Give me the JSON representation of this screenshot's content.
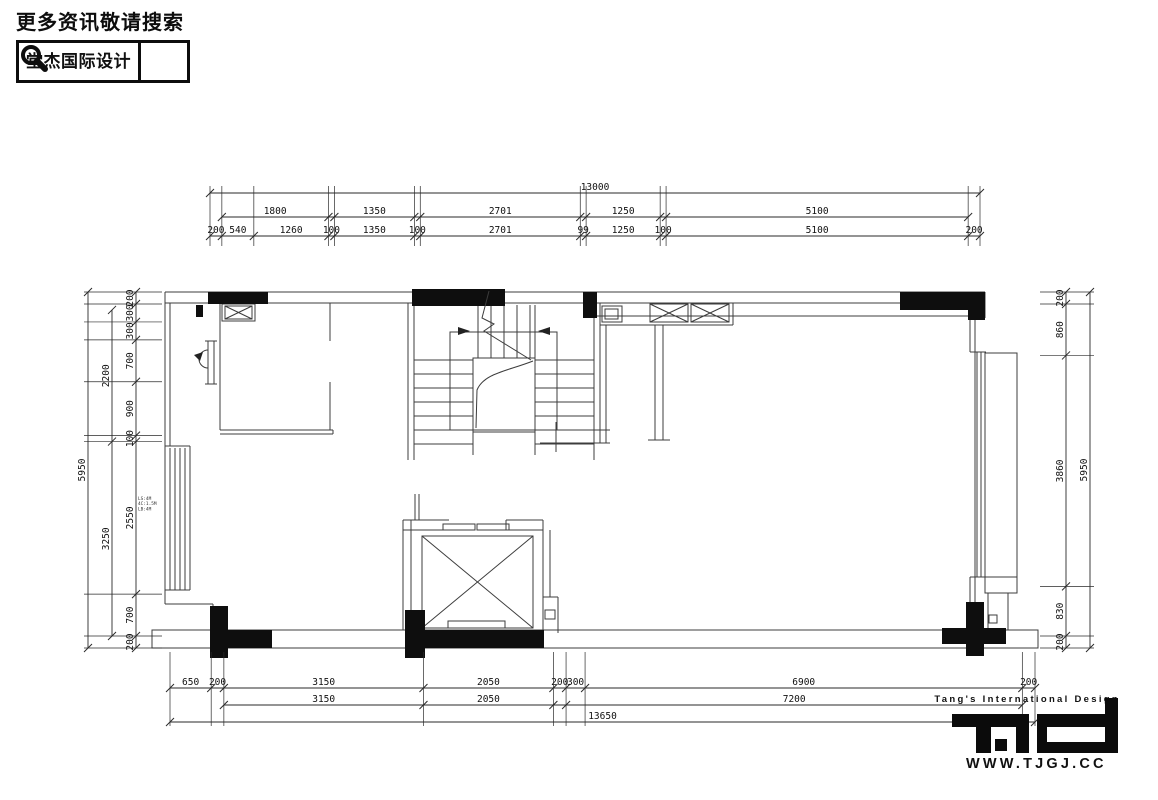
{
  "header": {
    "slogan": "更多资讯敬请搜索",
    "brand": "堂杰国际设计"
  },
  "plan": {
    "window_note": [
      "LS:4M",
      "4C:1.5M",
      "LB:4M"
    ]
  },
  "dims": {
    "top": {
      "total": "13000",
      "mid": [
        "1800",
        "1350",
        "2701",
        "1250",
        "5100"
      ],
      "detail": [
        "200",
        "540",
        "1260",
        "100",
        "1350",
        "100",
        "2701",
        "99",
        "1250",
        "100",
        "5100",
        "200"
      ]
    },
    "bottom": {
      "detail": [
        "650",
        "200",
        "3150",
        "2050",
        "200",
        "300",
        "6900",
        "200"
      ],
      "mid": [
        "3150",
        "2050",
        "7200"
      ],
      "total": "13650"
    },
    "left": {
      "total": "5950",
      "mid": [
        "2200",
        "3250"
      ],
      "detail": [
        "200",
        "300",
        "300",
        "700",
        "900",
        "100",
        "2550",
        "700",
        "200"
      ]
    },
    "right": {
      "total": "5950",
      "detail": [
        "200",
        "860",
        "3860",
        "830",
        "200"
      ]
    }
  },
  "footer": {
    "tagline": "Tang's International Design",
    "website": "WWW.TJGJ.CC"
  }
}
